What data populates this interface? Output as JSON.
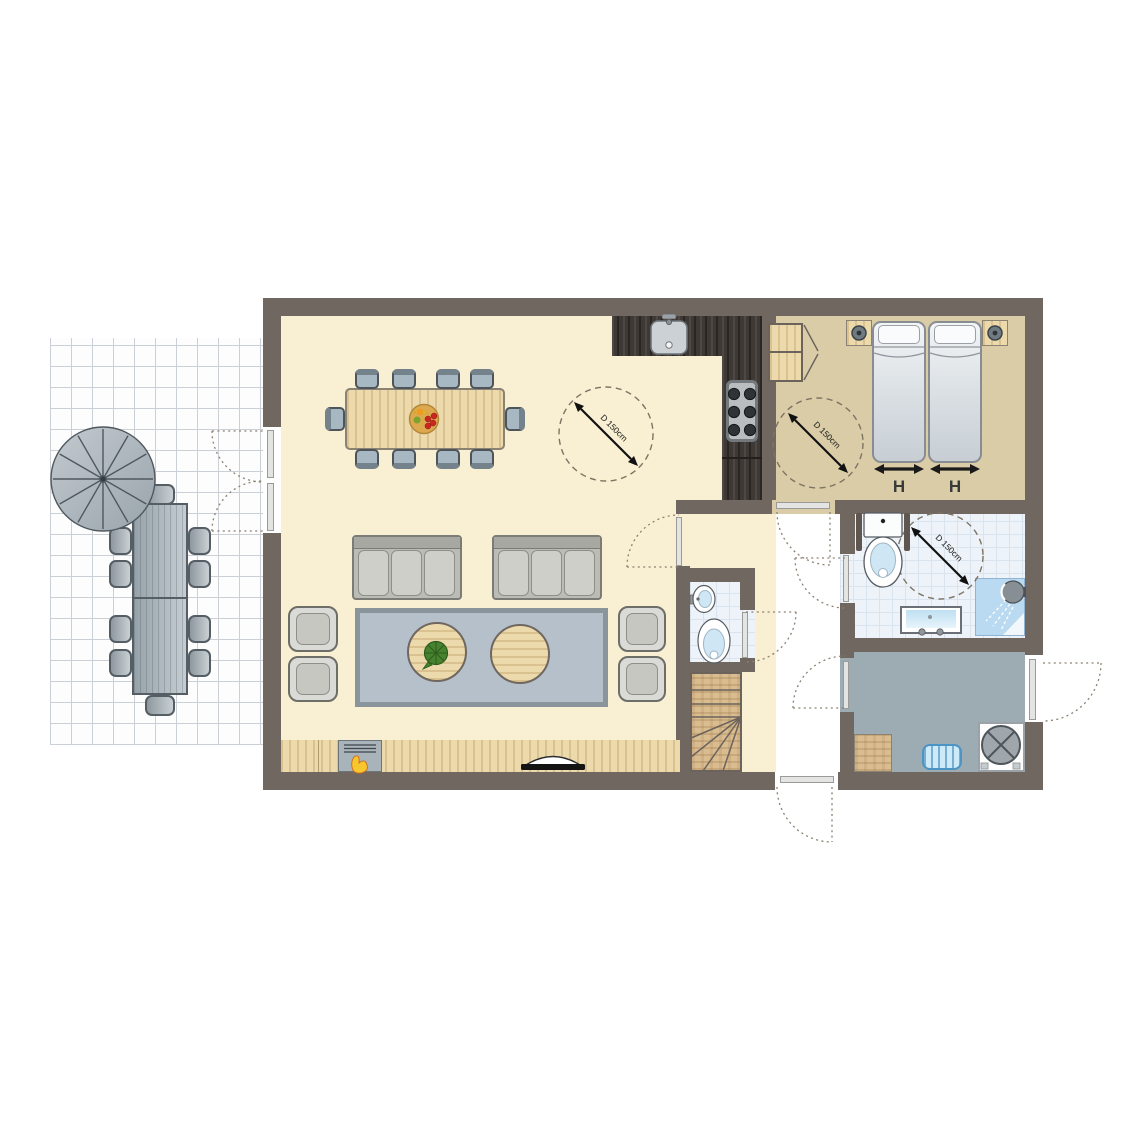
{
  "plan": {
    "clearances": [
      {
        "room": "living-room",
        "label": "D 150cm"
      },
      {
        "room": "bedroom",
        "label": "D 150cm"
      },
      {
        "room": "bathroom",
        "label": "D 150cm"
      }
    ],
    "beds": [
      {
        "width_label": "H"
      },
      {
        "width_label": "H"
      }
    ],
    "colors": {
      "wall": "#6f6760",
      "living_floor": "#f9efd3",
      "bedroom_floor": "#d9cca6",
      "bathroom_tile": "#eef3f9",
      "utility_floor": "#9dabb3",
      "light_wood": "#ecdaad",
      "kitchen_counter": "#3f3935",
      "water_blue": "#cfe6f4",
      "door_swing": "#8b8172"
    }
  }
}
